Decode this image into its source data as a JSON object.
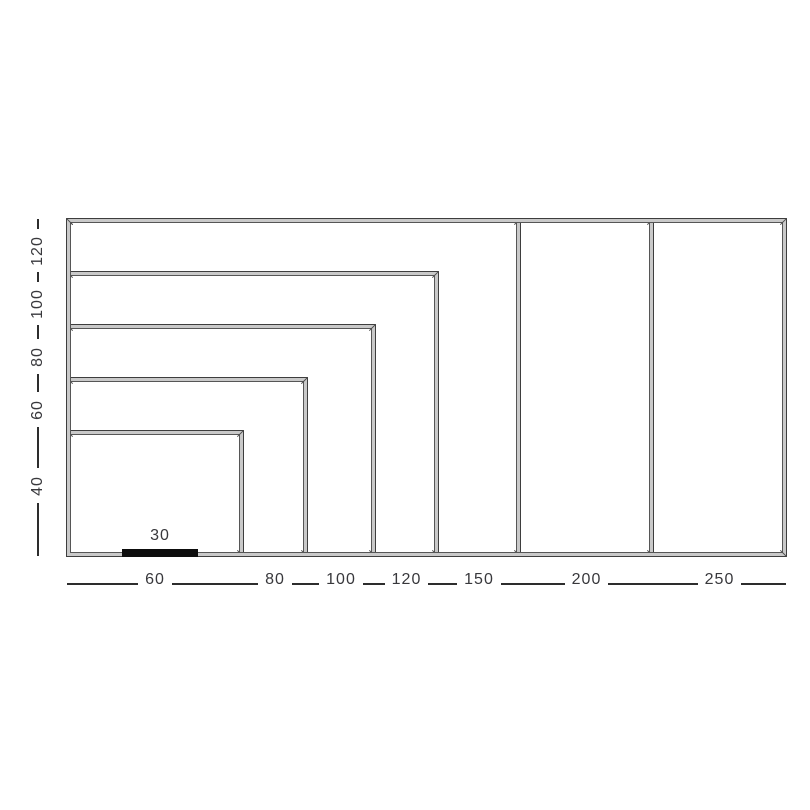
{
  "chart_data": {
    "type": "diagram",
    "subtype": "nested-size-rectangles",
    "description": "Seven nested rectangles anchored at a common bottom-left corner, each labeled by width (bottom axis) and height (left axis); a solid black bar labeled 30 serves as a scale reference.",
    "sizes": [
      {
        "width": 60,
        "height": 40
      },
      {
        "width": 80,
        "height": 60
      },
      {
        "width": 100,
        "height": 80
      },
      {
        "width": 120,
        "height": 100
      },
      {
        "width": 150,
        "height": 120
      },
      {
        "width": 200,
        "height": 120
      },
      {
        "width": 250,
        "height": 120
      }
    ],
    "left_axis_labels": [
      "120",
      "100",
      "80",
      "60",
      "40"
    ],
    "bottom_axis_labels": [
      "60",
      "80",
      "100",
      "120",
      "150",
      "200",
      "250"
    ],
    "reference_bar": {
      "label": "30"
    },
    "layout_hints": {
      "axis_style": "dashed line broken by labels",
      "left_label_rotation_deg": -90,
      "grid": false,
      "legend": false
    },
    "colors": {
      "background": "#ffffff",
      "line_dark": "#2d2d2d",
      "line_light": "#c9c9c9",
      "text": "#38383c",
      "reference_bar": "#0d0d0d"
    }
  }
}
